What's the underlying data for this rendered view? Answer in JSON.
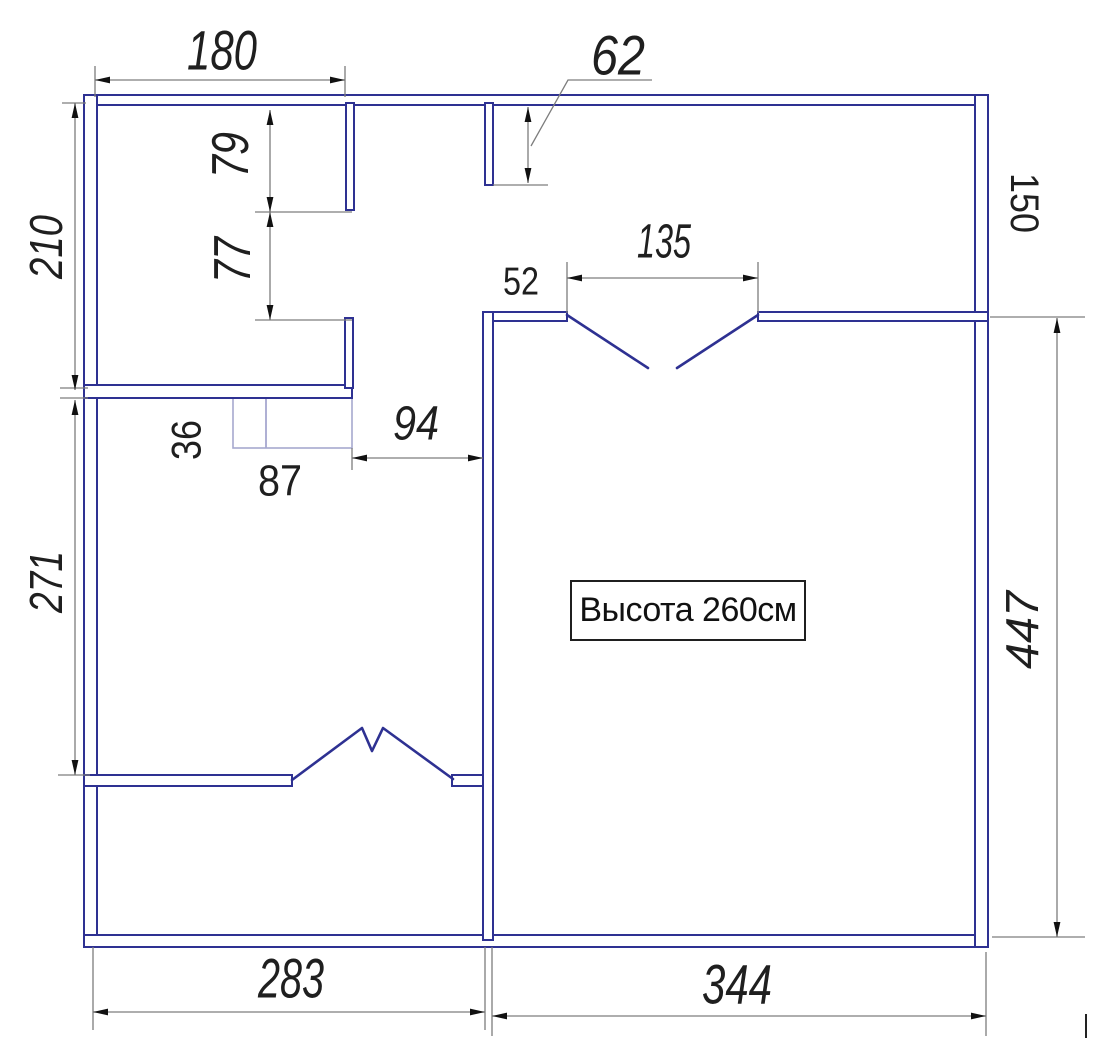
{
  "canvas": {
    "w": 1100,
    "h": 1052,
    "background": "#ffffff"
  },
  "colors": {
    "wall": "#2e3192",
    "door": "#2e3192",
    "fixture": "#a6a8cf",
    "dim_line": "#7d7d7d",
    "arrow": "#111111",
    "text": "#1f1f1f",
    "annotation_border": "#1f1f1f"
  },
  "annotation": {
    "label": "Высота 260см",
    "x": 570,
    "y": 580,
    "w": 232,
    "h": 57
  },
  "plan": {
    "walls": [
      {
        "name": "top-wall",
        "x": 84,
        "y": 95,
        "w": 904,
        "h": 10
      },
      {
        "name": "left-wall",
        "x": 84,
        "y": 95,
        "w": 13,
        "h": 852
      },
      {
        "name": "bottom-wall",
        "x": 84,
        "y": 935,
        "w": 904,
        "h": 12
      },
      {
        "name": "right-wall",
        "x": 975,
        "y": 95,
        "w": 13,
        "h": 852
      },
      {
        "name": "top-stub-left",
        "x": 346,
        "y": 103,
        "w": 8,
        "h": 107
      },
      {
        "name": "top-stub-right",
        "x": 485,
        "y": 103,
        "w": 8,
        "h": 82
      },
      {
        "name": "left-divider-wall",
        "x": 84,
        "y": 385,
        "w": 268,
        "h": 13
      },
      {
        "name": "left-divider-stub",
        "x": 345,
        "y": 318,
        "w": 8,
        "h": 70
      },
      {
        "name": "hall-wall-52",
        "x": 483,
        "y": 312,
        "w": 84,
        "h": 9
      },
      {
        "name": "hall-wall-right",
        "x": 758,
        "y": 312,
        "w": 230,
        "h": 9
      },
      {
        "name": "middle-wall",
        "x": 483,
        "y": 312,
        "w": 10,
        "h": 628
      },
      {
        "name": "lower-room-wall-left",
        "x": 84,
        "y": 775,
        "w": 208,
        "h": 11
      },
      {
        "name": "lower-room-wall-stub",
        "x": 452,
        "y": 775,
        "w": 31,
        "h": 11
      }
    ],
    "doors": [
      {
        "name": "double-door-right-room-left-leaf",
        "points": [
          [
            567,
            315
          ],
          [
            648,
            368
          ]
        ]
      },
      {
        "name": "double-door-right-room-right-leaf",
        "points": [
          [
            758,
            315
          ],
          [
            677,
            368
          ]
        ]
      },
      {
        "name": "double-door-lower-room",
        "points": [
          [
            292,
            780
          ],
          [
            362,
            728
          ],
          [
            372,
            751
          ],
          [
            383,
            728
          ],
          [
            453,
            779
          ]
        ]
      }
    ],
    "fixture": {
      "name": "vent-box",
      "x": 233,
      "y": 398,
      "w": 119,
      "h": 50,
      "divider_x": 266
    },
    "dim_lines": [
      {
        "name": "dim-line-180",
        "x1": 95,
        "y1": 80,
        "x2": 345,
        "y2": 80
      },
      {
        "name": "dim-line-62",
        "x1": 528,
        "y1": 107,
        "x2": 528,
        "y2": 183
      },
      {
        "name": "dim-line-79",
        "x1": 270,
        "y1": 110,
        "x2": 270,
        "y2": 212
      },
      {
        "name": "dim-line-77",
        "x1": 270,
        "y1": 212,
        "x2": 270,
        "y2": 320
      },
      {
        "name": "dim-line-210",
        "x1": 75,
        "y1": 103,
        "x2": 75,
        "y2": 390
      },
      {
        "name": "dim-line-271",
        "x1": 75,
        "y1": 400,
        "x2": 75,
        "y2": 775
      },
      {
        "name": "dim-line-135",
        "x1": 567,
        "y1": 278,
        "x2": 758,
        "y2": 278
      },
      {
        "name": "dim-line-94",
        "x1": 352,
        "y1": 458,
        "x2": 483,
        "y2": 458
      },
      {
        "name": "dim-line-447",
        "x1": 1057,
        "y1": 318,
        "x2": 1057,
        "y2": 937
      },
      {
        "name": "dim-line-283",
        "x1": 93,
        "y1": 1012,
        "x2": 485,
        "y2": 1012
      },
      {
        "name": "dim-line-344",
        "x1": 492,
        "y1": 1016,
        "x2": 986,
        "y2": 1016
      }
    ],
    "ext_lines": [
      [
        95,
        66,
        95,
        97
      ],
      [
        345,
        66,
        345,
        97
      ],
      [
        493,
        185,
        548,
        185
      ],
      [
        255,
        212,
        352,
        212
      ],
      [
        255,
        320,
        352,
        320
      ],
      [
        62,
        103,
        86,
        103
      ],
      [
        60,
        388,
        88,
        388
      ],
      [
        60,
        398,
        88,
        398
      ],
      [
        58,
        775,
        90,
        775
      ],
      [
        567,
        262,
        567,
        313
      ],
      [
        758,
        262,
        758,
        313
      ],
      [
        352,
        448,
        352,
        470
      ],
      [
        990,
        317,
        1085,
        317
      ],
      [
        992,
        937,
        1085,
        937
      ],
      [
        93,
        947,
        93,
        1030
      ],
      [
        485,
        947,
        485,
        1030
      ],
      [
        492,
        947,
        492,
        1036
      ],
      [
        986,
        952,
        986,
        1036
      ]
    ],
    "leader_62": {
      "name": "leader-line-62",
      "points": [
        [
          652,
          80
        ],
        [
          568,
          80
        ],
        [
          531,
          146
        ]
      ]
    },
    "corner_tick": {
      "name": "corner-tick",
      "x1": 1086,
      "y1": 1014,
      "x2": 1086,
      "y2": 1038
    }
  },
  "labels": [
    {
      "name": "dim-label-180",
      "text": "180",
      "x": 222,
      "y": 50,
      "fs": 56,
      "italic": true,
      "rot": 0,
      "len": 70
    },
    {
      "name": "dim-label-62",
      "text": "62",
      "x": 618,
      "y": 55,
      "fs": 56,
      "italic": true,
      "rot": 0,
      "len": 54
    },
    {
      "name": "dim-label-79",
      "text": "79",
      "x": 231,
      "y": 155,
      "fs": 52,
      "italic": true,
      "rot": -90,
      "len": 46
    },
    {
      "name": "dim-label-77",
      "text": "77",
      "x": 233,
      "y": 260,
      "fs": 52,
      "italic": true,
      "rot": -90,
      "len": 46
    },
    {
      "name": "dim-label-210",
      "text": "210",
      "x": 46,
      "y": 247,
      "fs": 46,
      "italic": true,
      "rot": -90,
      "len": 64
    },
    {
      "name": "dim-label-271",
      "text": "271",
      "x": 46,
      "y": 582,
      "fs": 46,
      "italic": true,
      "rot": -90,
      "len": 62
    },
    {
      "name": "dim-label-135",
      "text": "135",
      "x": 664,
      "y": 242,
      "fs": 48,
      "italic": true,
      "rot": 0,
      "len": 54
    },
    {
      "name": "dim-label-52",
      "text": "52",
      "x": 521,
      "y": 282,
      "fs": 39,
      "italic": false,
      "rot": 0,
      "len": 36
    },
    {
      "name": "dim-label-94",
      "text": "94",
      "x": 416,
      "y": 424,
      "fs": 48,
      "italic": true,
      "rot": 0,
      "len": 46
    },
    {
      "name": "dim-label-36",
      "text": "36",
      "x": 186,
      "y": 440,
      "fs": 42,
      "italic": false,
      "rot": -90,
      "len": 40
    },
    {
      "name": "dim-label-87",
      "text": "87",
      "x": 280,
      "y": 481,
      "fs": 44,
      "italic": false,
      "rot": 0,
      "len": 44
    },
    {
      "name": "dim-label-150",
      "text": "150",
      "x": 1024,
      "y": 203,
      "fs": 40,
      "italic": false,
      "rot": 90,
      "len": 60
    },
    {
      "name": "dim-label-447",
      "text": "447",
      "x": 1022,
      "y": 630,
      "fs": 46,
      "italic": true,
      "rot": -90,
      "len": 78
    },
    {
      "name": "dim-label-283",
      "text": "283",
      "x": 291,
      "y": 978,
      "fs": 56,
      "italic": true,
      "rot": 0,
      "len": 66
    },
    {
      "name": "dim-label-344",
      "text": "344",
      "x": 737,
      "y": 984,
      "fs": 56,
      "italic": true,
      "rot": 0,
      "len": 70
    }
  ]
}
